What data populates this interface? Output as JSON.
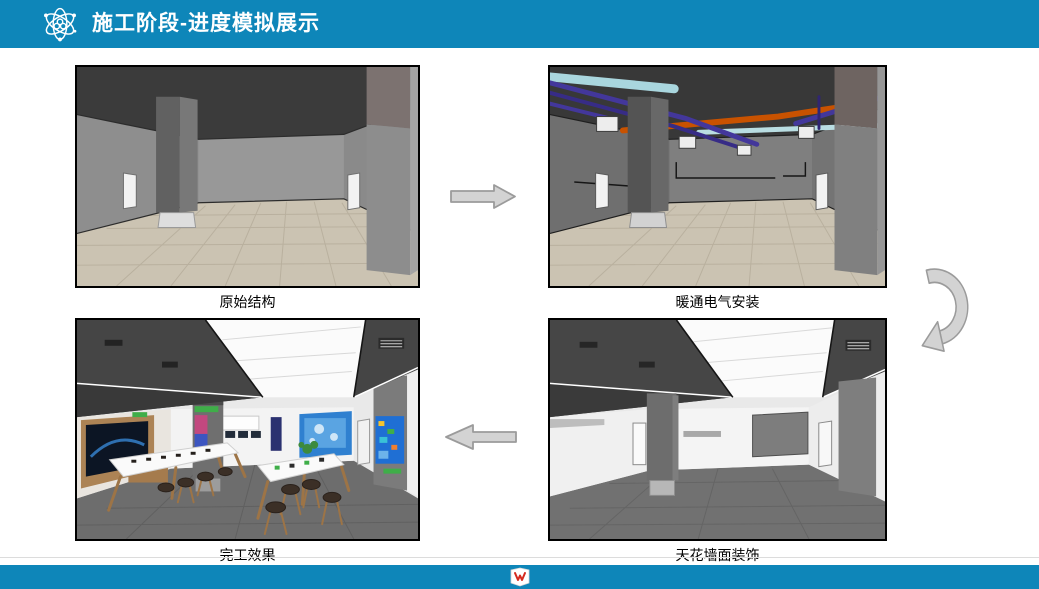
{
  "header": {
    "title": "施工阶段-进度模拟展示",
    "icon": "atom-icon",
    "bg_color": "#0E86B9",
    "text_color": "#FFFFFF"
  },
  "stages": [
    {
      "caption": "原始结构",
      "position": "top-left"
    },
    {
      "caption": "暖通电气安装",
      "position": "top-right"
    },
    {
      "caption": "天花墙面装饰",
      "position": "bottom-right"
    },
    {
      "caption": "完工效果",
      "position": "bottom-left"
    }
  ],
  "arrows": [
    {
      "from": 1,
      "to": 2,
      "shape": "block-arrow",
      "direction": "right"
    },
    {
      "from": 2,
      "to": 3,
      "shape": "curved-arrow",
      "direction": "down-left"
    },
    {
      "from": 3,
      "to": 4,
      "shape": "block-arrow",
      "direction": "left"
    }
  ],
  "footer": {
    "logo": "brand-logo",
    "bg_color": "#0E86B9"
  },
  "colors": {
    "accent_teal": "#0E86B9",
    "arrow_fill": "#D3D3D3",
    "arrow_outline": "#9B9B9B",
    "caption_text": "#000000",
    "figure_border": "#000000"
  }
}
